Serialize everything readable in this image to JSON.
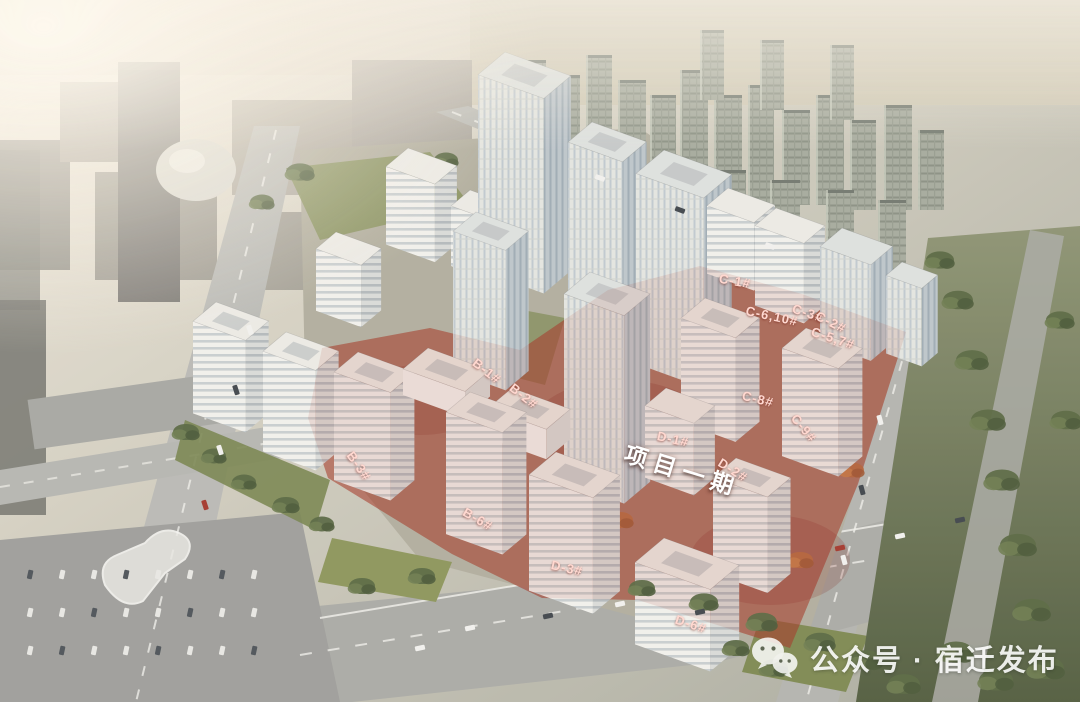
{
  "annotations": {
    "phase_area_label": {
      "text": "项目一期",
      "x_pct": 63.2,
      "y_pct": 66.8,
      "rotate_deg": 17
    },
    "building_labels": [
      {
        "id": "B-1",
        "text": "B-1#",
        "x_pct": 45.1,
        "y_pct": 52.8,
        "rotate_deg": 38
      },
      {
        "id": "B-2",
        "text": "B-2#",
        "x_pct": 48.5,
        "y_pct": 56.4,
        "rotate_deg": 38
      },
      {
        "id": "B-3",
        "text": "B-3#",
        "x_pct": 33.2,
        "y_pct": 66.4,
        "rotate_deg": 55
      },
      {
        "id": "B-6",
        "text": "B-6#",
        "x_pct": 44.3,
        "y_pct": 73.9,
        "rotate_deg": 30
      },
      {
        "id": "C-1",
        "text": "C-1#",
        "x_pct": 68.1,
        "y_pct": 40.0,
        "rotate_deg": 10
      },
      {
        "id": "C-6-10",
        "text": "C-6,10#",
        "x_pct": 71.5,
        "y_pct": 45.0,
        "rotate_deg": 12
      },
      {
        "id": "C-3",
        "text": "C-3#",
        "x_pct": 74.8,
        "y_pct": 44.6,
        "rotate_deg": 18
      },
      {
        "id": "C-2",
        "text": "C-2#",
        "x_pct": 76.9,
        "y_pct": 45.9,
        "rotate_deg": 26
      },
      {
        "id": "C-5-7",
        "text": "C-5,7#",
        "x_pct": 77.1,
        "y_pct": 48.2,
        "rotate_deg": 18
      },
      {
        "id": "C-8",
        "text": "C-8#",
        "x_pct": 70.2,
        "y_pct": 56.8,
        "rotate_deg": 14
      },
      {
        "id": "C-9",
        "text": "C-9#",
        "x_pct": 74.4,
        "y_pct": 61.0,
        "rotate_deg": 50
      },
      {
        "id": "D-1",
        "text": "D-1#",
        "x_pct": 62.3,
        "y_pct": 62.5,
        "rotate_deg": 12
      },
      {
        "id": "D-2",
        "text": "D-2#",
        "x_pct": 67.9,
        "y_pct": 66.9,
        "rotate_deg": 32
      },
      {
        "id": "D-3",
        "text": "D-3#",
        "x_pct": 52.5,
        "y_pct": 80.9,
        "rotate_deg": 12
      },
      {
        "id": "D-6",
        "text": "D-6#",
        "x_pct": 64.0,
        "y_pct": 88.9,
        "rotate_deg": 18
      }
    ]
  },
  "watermark": {
    "icon": "wechat-icon",
    "text": "公众号 · 宿迁发布"
  },
  "colors": {
    "phase_overlay_red": "#a23120",
    "label_text": "#ffd8d0",
    "phase_label_text": "#ffffff",
    "watermark_text": "#ffffff"
  }
}
